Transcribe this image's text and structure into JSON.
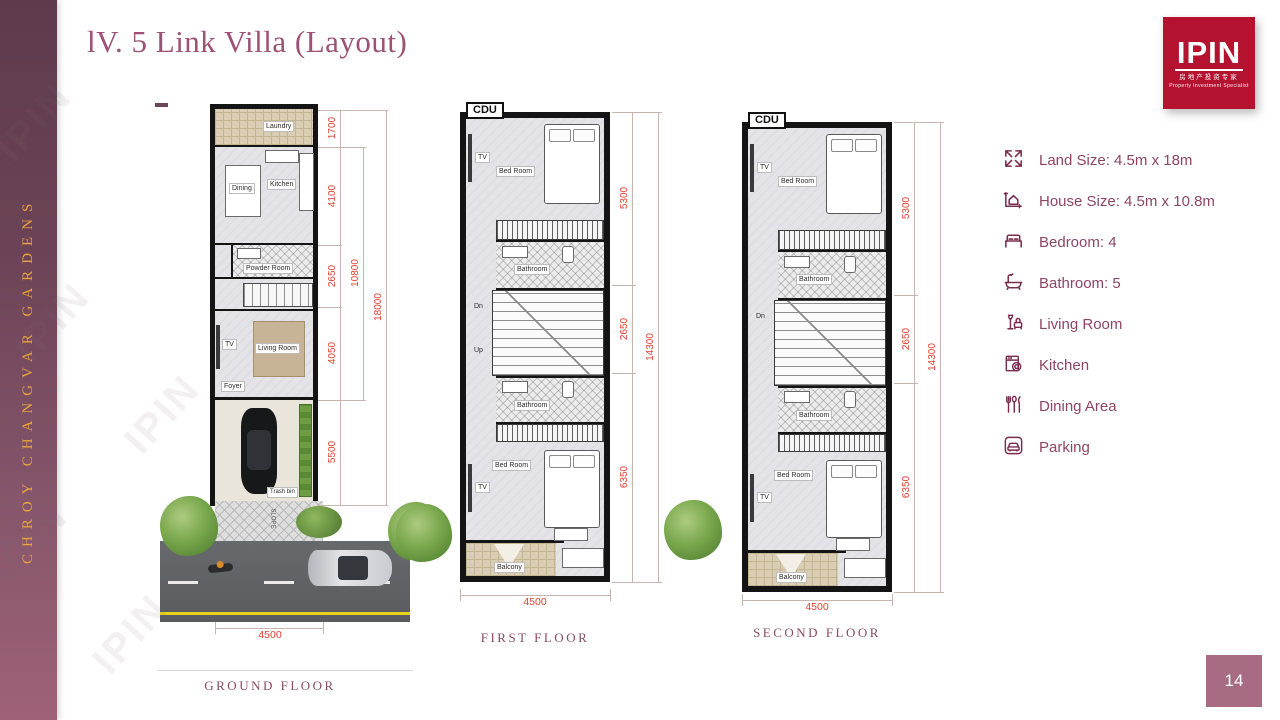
{
  "slide": {
    "title": "lV. 5 Link Villa (Layout)",
    "sidebar_text": "CHROY CHANGVAR GARDENS",
    "watermark": "IPIN",
    "page_number": "14"
  },
  "logo": {
    "name": "IPIN",
    "chinese": "房地产投资专家",
    "tagline": "Property Investment Specialist",
    "bg_color": "#B5122F"
  },
  "colors": {
    "title_maroon": "#9D5176",
    "sidebar_gold": "#EAA33E",
    "dimension_red": "#E2412F",
    "caption_maroon": "#8C4A63",
    "page_badge": "#A76C83"
  },
  "specs": {
    "items": [
      {
        "icon": "land-size",
        "label": "Land Size: 4.5m x 18m"
      },
      {
        "icon": "house-size",
        "label": "House Size: 4.5m x 10.8m"
      },
      {
        "icon": "bedroom",
        "label": "Bedroom: 4"
      },
      {
        "icon": "bathroom",
        "label": "Bathroom: 5"
      },
      {
        "icon": "living-room",
        "label": "Living Room"
      },
      {
        "icon": "kitchen",
        "label": "Kitchen"
      },
      {
        "icon": "dining",
        "label": "Dining Area"
      },
      {
        "icon": "parking",
        "label": "Parking"
      }
    ]
  },
  "plans": {
    "ground": {
      "label": "GROUND FLOOR",
      "rooms": {
        "laundry": "Laundry",
        "dining": "Dining",
        "kitchen": "Kitchen",
        "powder_room": "Powder Room",
        "living_room": "Living Room",
        "foyer": "Foyer",
        "tv": "TV",
        "trash_bin": "Trash bin",
        "slope": "SLOPE"
      },
      "dims": {
        "sections": [
          "1700",
          "4100",
          "2650",
          "4050",
          "5500"
        ],
        "inner": "10800",
        "total": "18000",
        "width": "4500"
      }
    },
    "first": {
      "label": "FIRST FLOOR",
      "cdu": "CDU",
      "rooms": {
        "bedroom": "Bed Room",
        "bathroom": "Bathroom",
        "tv": "TV",
        "dn": "Dn",
        "up": "Up",
        "balcony": "Balcony"
      },
      "dims": {
        "sections": [
          "5300",
          "2650",
          "6350"
        ],
        "total": "14300",
        "width": "4500"
      }
    },
    "second": {
      "label": "SECOND FLOOR",
      "cdu": "CDU",
      "rooms": {
        "bedroom": "Bed Room",
        "bathroom": "Bathroom",
        "tv": "TV",
        "dn": "Dn",
        "balcony": "Balcony"
      },
      "dims": {
        "sections": [
          "5300",
          "2650",
          "6350"
        ],
        "total": "14300",
        "width": "4500"
      }
    }
  }
}
